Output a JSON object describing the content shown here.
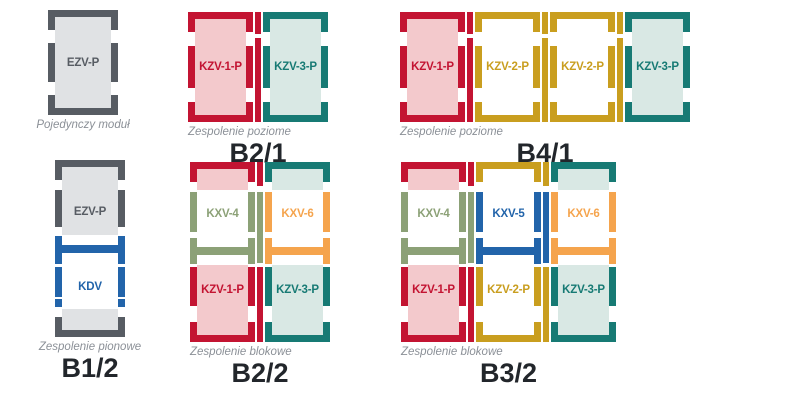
{
  "colors": {
    "red": "#c31432",
    "red_fill": "#f3c9cc",
    "teal": "#177a74",
    "teal_fill": "#d9e8e4",
    "gold": "#c99e1f",
    "white_fill": "#ffffff",
    "gray": "#575c63",
    "gray_fill": "#e0e2e4",
    "blue": "#2264aa",
    "green": "#8ca177",
    "orange": "#f5a44d",
    "caption": "#8b9097",
    "name": "#22262b",
    "background": "#ffffff"
  },
  "groups": {
    "single": {
      "caption": "Pojedynczy moduł",
      "module_label": "EZV-P"
    },
    "b21": {
      "caption": "Zespolenie poziome",
      "name": "B2/1",
      "labels": [
        "KZV-1-P",
        "KZV-3-P"
      ]
    },
    "b41": {
      "caption": "Zespolenie poziome",
      "name": "B4/1",
      "labels": [
        "KZV-1-P",
        "KZV-2-P",
        "KZV-2-P",
        "KZV-3-P"
      ]
    },
    "b12": {
      "caption": "Zespolenie pionowe",
      "name": "B1/2",
      "labels": [
        "EZV-P",
        "KDV"
      ]
    },
    "b22": {
      "caption": "Zespolenie blokowe",
      "name": "B2/2",
      "top_labels": [
        "KXV-4",
        "KXV-6"
      ],
      "bottom_labels": [
        "KZV-1-P",
        "KZV-3-P"
      ]
    },
    "b32": {
      "caption": "Zespolenie blokowe",
      "name": "B3/2",
      "top_labels": [
        "KXV-4",
        "KXV-5",
        "KXV-6"
      ],
      "bottom_labels": [
        "KZV-1-P",
        "KZV-2-P",
        "KZV-3-P"
      ]
    }
  }
}
